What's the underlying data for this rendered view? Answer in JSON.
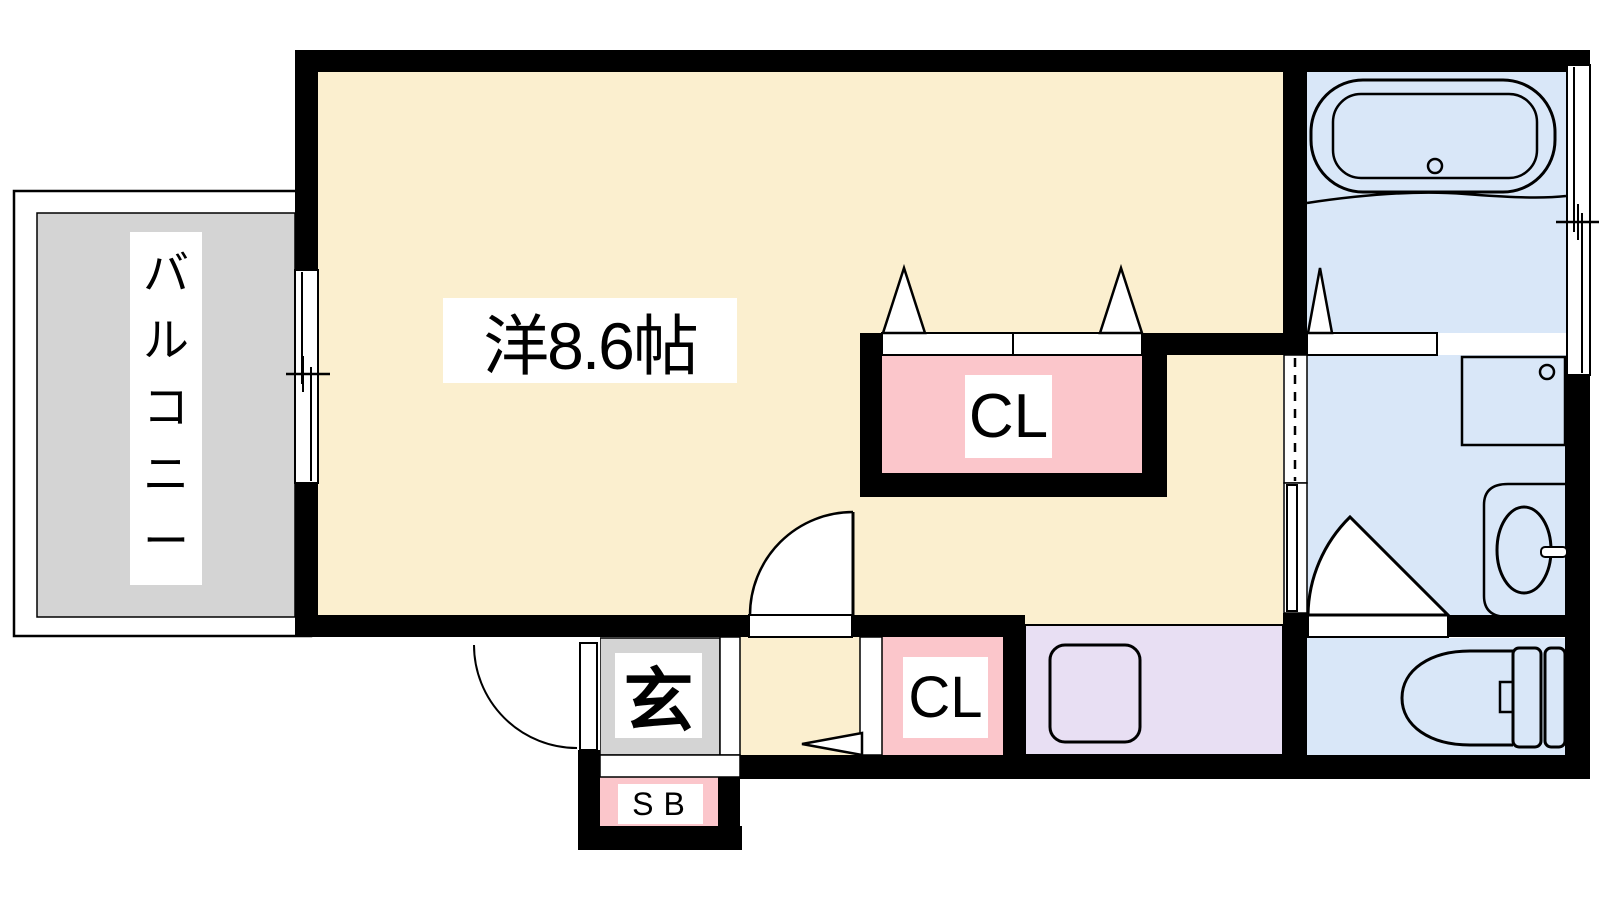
{
  "rooms": {
    "main_room": {
      "label": "洋8.6帖"
    },
    "balcony": {
      "label": "バルコニー"
    },
    "closet_main": {
      "label": "CL"
    },
    "closet_hall": {
      "label": "CL"
    },
    "entrance": {
      "label": "玄"
    },
    "shoe_box": {
      "label": "SB"
    }
  },
  "colors": {
    "wall": "#000000",
    "room_cream": "#FBEFCF",
    "wet_area_blue": "#D9E7F8",
    "closet_pink": "#FBC6CB",
    "kitchen_purple": "#E8DFF3",
    "balcony_gray": "#D4D4D4",
    "label_background": "#FFFFFF",
    "text": "#000000"
  }
}
